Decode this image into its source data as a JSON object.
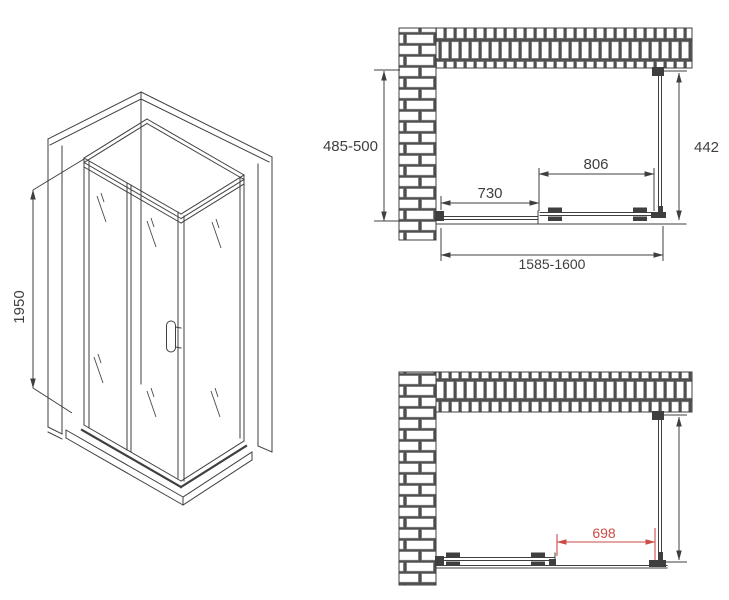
{
  "drawing": {
    "colors": {
      "background": "#ffffff",
      "line": "#3f3f3f",
      "accent_red": "#cc4a47",
      "brick_mortar": "#4f4f4f",
      "brick_face": "#ffffff"
    },
    "iso_view": {
      "height_label": "1950"
    },
    "top_view": {
      "depth_label": "485-500",
      "side_panel_label": "442",
      "door_label": "806",
      "fixed_panel_label": "730",
      "total_width_label": "1585-1600"
    },
    "bottom_view": {
      "opening_label": "698"
    }
  }
}
